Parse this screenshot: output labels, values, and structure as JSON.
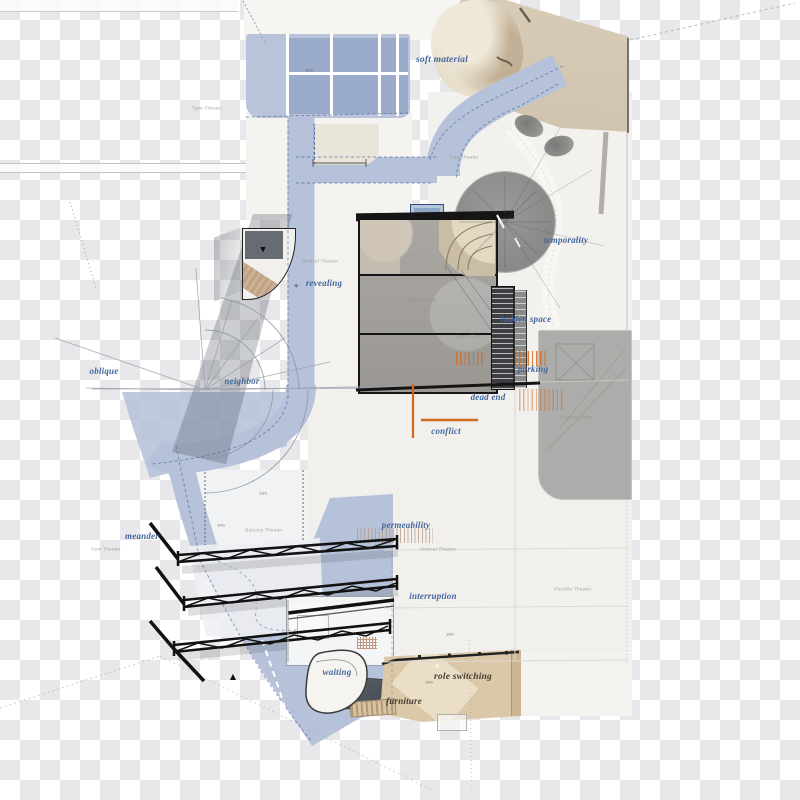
{
  "canvas": {
    "width": 800,
    "height": 800,
    "kind": "architectural-site-plan"
  },
  "colors": {
    "road_blue": "#b6c2d9",
    "parking_bay_blue": "#9aaac9",
    "parking_light_blue": "#b9c4da",
    "annotation_blue": "#44679e",
    "annotation_dark": "#453e34",
    "tan_top": "#d3c7b2",
    "tan_bottom": "#dbc8a9",
    "concrete_gray": "#a3a09b",
    "circle_gray": "#8f8f8d",
    "structure_gray": "#acacaa",
    "orange_accent": "#d2691e",
    "truss_black": "#121212",
    "pavement": "#f2f1ed",
    "checker_gray": "#e8e8ea"
  },
  "annotation_labels": [
    {
      "name": "label-soft-material",
      "text": "soft material",
      "x": 442,
      "y": 60,
      "size": 9.5
    },
    {
      "name": "label-temporality",
      "text": "temporality",
      "x": 566,
      "y": 240
    },
    {
      "name": "label-revealing",
      "text": "revealing",
      "x": 324,
      "y": 283
    },
    {
      "name": "label-hidden-space",
      "text": "hidden space",
      "x": 526,
      "y": 319
    },
    {
      "name": "label-parking",
      "text": "parking",
      "x": 533,
      "y": 369
    },
    {
      "name": "label-dead-end",
      "text": "dead end",
      "x": 488,
      "y": 397
    },
    {
      "name": "label-conflict",
      "text": "conflict",
      "x": 446,
      "y": 431
    },
    {
      "name": "label-oblique",
      "text": "oblique",
      "x": 104,
      "y": 371
    },
    {
      "name": "label-neighbor",
      "text": "neighbor",
      "x": 242,
      "y": 381
    },
    {
      "name": "label-meander",
      "text": "meander",
      "x": 142,
      "y": 536
    },
    {
      "name": "label-permeability",
      "text": "permeability",
      "x": 406,
      "y": 525
    },
    {
      "name": "label-interruption",
      "text": "interruption",
      "x": 433,
      "y": 596
    },
    {
      "name": "label-waiting",
      "text": "waiting",
      "x": 337,
      "y": 672
    },
    {
      "name": "label-role-switching",
      "text": "role switching",
      "x": 463,
      "y": 677,
      "size": 9.5,
      "color": "#453e34"
    },
    {
      "name": "label-furniture",
      "text": "furniture",
      "x": 404,
      "y": 701,
      "color": "#453e34"
    }
  ],
  "zone_labels": [
    {
      "name": "zone-type-theater",
      "text": "Type Theater",
      "x": 207,
      "y": 108
    },
    {
      "name": "zone-tree-theater",
      "text": "Tree Theater",
      "x": 464,
      "y": 157
    },
    {
      "name": "zone-vertical-theater-upper",
      "text": "Vertical Theater",
      "x": 320,
      "y": 261
    },
    {
      "name": "zone-gaming-zone",
      "text": "Gaming Zone",
      "x": 421,
      "y": 300
    },
    {
      "name": "zone-upper-floor",
      "text": "Upper Floor",
      "x": 469,
      "y": 336
    },
    {
      "name": "zone-outdoor-plaza",
      "text": "Outdoor Plaza",
      "x": 576,
      "y": 417
    },
    {
      "name": "zone-balcony-theater",
      "text": "Balcony Theater",
      "x": 264,
      "y": 530
    },
    {
      "name": "zone-gym-theater",
      "text": "Gym Theater",
      "x": 106,
      "y": 549
    },
    {
      "name": "zone-vertical-theater-lower",
      "text": "Vertical Theater",
      "x": 438,
      "y": 549
    },
    {
      "name": "zone-flexible-theater",
      "text": "Flexible Theater",
      "x": 573,
      "y": 589
    }
  ],
  "scale_markers": [
    {
      "name": "scale-30m",
      "text": "30m",
      "x": 309,
      "y": 70
    },
    {
      "name": "scale-10m-a",
      "text": "10m",
      "x": 263,
      "y": 493
    },
    {
      "name": "scale-10m-b",
      "text": "10m",
      "x": 221,
      "y": 525
    },
    {
      "name": "scale-10m-c",
      "text": "10m",
      "x": 450,
      "y": 634
    },
    {
      "name": "scale-10m-d",
      "text": "10m",
      "x": 429,
      "y": 682
    }
  ],
  "glyph_markers": [
    {
      "name": "marker-triangle-down",
      "text": "▼",
      "x": 263,
      "y": 250,
      "color": "#0e0e0e",
      "size": 7
    },
    {
      "name": "marker-triangle-up",
      "text": "▲",
      "x": 233,
      "y": 677,
      "color": "#0e0e0e",
      "size": 8
    },
    {
      "name": "marker-asterisk",
      "text": "✳",
      "x": 296,
      "y": 287,
      "color": "#3c4a66",
      "size": 6
    },
    {
      "name": "marker-cross",
      "text": "✕",
      "x": 317,
      "y": 695,
      "color": "#ffffff",
      "size": 6
    },
    {
      "name": "marker-figure-dot",
      "text": "●",
      "x": 437,
      "y": 667,
      "color": "#f2efe8",
      "size": 5
    }
  ]
}
